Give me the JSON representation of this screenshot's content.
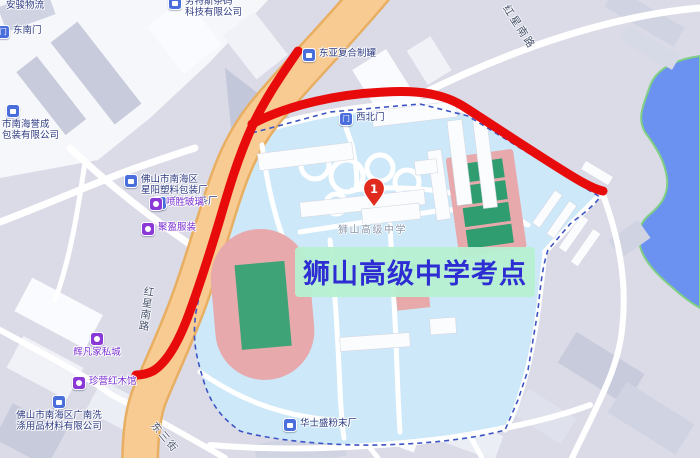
{
  "exam_site_label": {
    "text": "狮山高级中学考点",
    "text_color": "#2d2dd3",
    "bg_color": "#b6f0d1"
  },
  "school_label": "狮山高级中学",
  "marker": {
    "number": "1",
    "color": "#e02a1e"
  },
  "road_labels": {
    "hongxing_top": "红星南路",
    "hongxing_left": "红星南路",
    "dongsan": "东三街"
  },
  "pois": [
    {
      "line1": "安骏物流",
      "type": "company"
    },
    {
      "line1": "东南门",
      "type": "gate",
      "icon_glyph": "门"
    },
    {
      "line1": "劳特斯条码",
      "line2": "科技有限公司",
      "type": "company"
    },
    {
      "line1": "东亚复合制罐",
      "type": "company"
    },
    {
      "line1": "市南海誉成",
      "line2": "包装有限公司",
      "type": "company"
    },
    {
      "line1": "佛山市南海区",
      "line2": "星阳塑料包装厂",
      "type": "company"
    },
    {
      "line1": "合才分条厂",
      "type": "company"
    },
    {
      "line1": "喷胜玻璃",
      "type": "shop"
    },
    {
      "line1": "聚盈服装",
      "type": "shop"
    },
    {
      "line1": "辉凡家私城",
      "type": "shop"
    },
    {
      "line1": "珍营红木馆",
      "type": "shop"
    },
    {
      "line1": "佛山市南海区广南洗",
      "line2": "涤用品材料有限公司",
      "type": "company"
    },
    {
      "line1": "华士盛粉末厂",
      "type": "company"
    },
    {
      "line1": "西北门",
      "type": "gate",
      "icon_glyph": "门"
    }
  ],
  "colors": {
    "background": "#dadbe7",
    "campus_fill": "#cde8f8",
    "campus_boundary": "#3d55c4",
    "water_fill": "#6b92f0",
    "shoreline_green": "#7fcf84",
    "main_road_fill": "#f7cb92",
    "main_road_casing": "#e8ae62",
    "route_red": "#e80b0b",
    "track_pink": "#e7a9ab",
    "field_green": "#3fa378",
    "court_green": "#2f9d6f",
    "poi_text_navy": "#2c3a80",
    "poi_text_purple": "#7b2fd2",
    "building_gray": "#c7cbdb",
    "building_white": "#f8fafd"
  }
}
